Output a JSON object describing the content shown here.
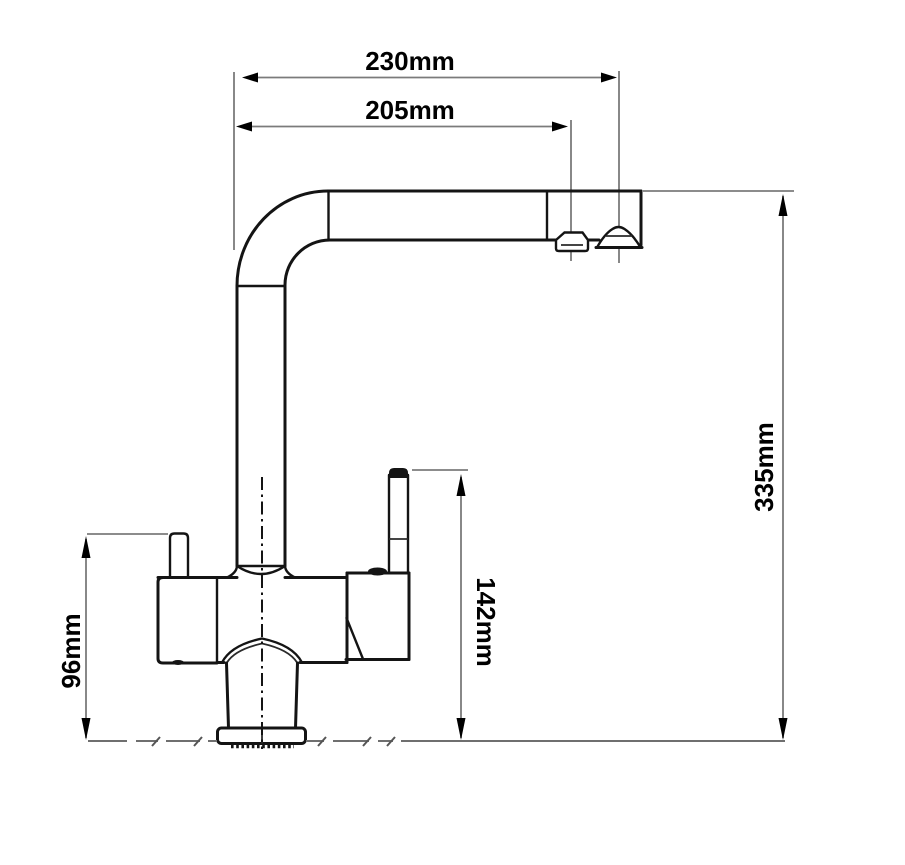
{
  "drawing": {
    "labels": {
      "spout_reach_overall": "230mm",
      "spout_reach_to_aerator": "205mm",
      "overall_height": "335mm",
      "handle_top_height": "142mm",
      "body_height": "96mm"
    },
    "colors": {
      "outline": "#141414",
      "dimension_line": "#7b7b7b",
      "arrowhead": "#000000",
      "ground_line": "#6f6f6f",
      "background": "#ffffff"
    }
  }
}
